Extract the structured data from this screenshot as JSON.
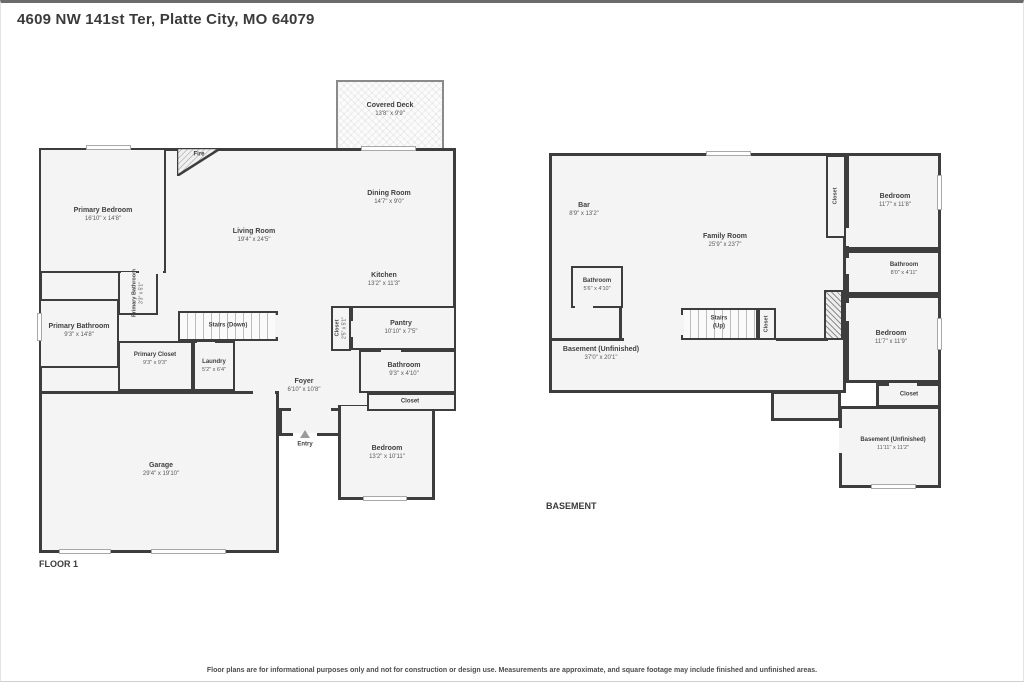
{
  "title": "4609 NW 141st Ter, Platte City, MO 64079",
  "disclaimer": "Floor plans are for informational purposes only and not for construction or design use. Measurements are approximate, and square footage may include finished and unfinished areas.",
  "colors": {
    "wall": "#3d3d3d",
    "room_fill": "#f4f4f4",
    "label_text": "#3f3f3f"
  },
  "floor1": {
    "label": "FLOOR 1",
    "rooms": {
      "covered_deck": {
        "name": "Covered Deck",
        "dims": "13'8\" x 9'9\""
      },
      "fire": {
        "name": "Fire"
      },
      "primary_bedroom": {
        "name": "Primary Bedroom",
        "dims": "16'10\" x 14'8\""
      },
      "living_room": {
        "name": "Living Room",
        "dims": "19'4\" x 24'5\""
      },
      "dining_room": {
        "name": "Dining Room",
        "dims": "14'7\" x 9'0\""
      },
      "kitchen": {
        "name": "Kitchen",
        "dims": "13'2\" x 11'3\""
      },
      "primary_bath_wc": {
        "name": "Primary Bathroom",
        "dims": "3'3\" x 5'1\""
      },
      "primary_bathroom": {
        "name": "Primary Bathroom",
        "dims": "9'3\" x 14'8\""
      },
      "stairs_down": {
        "name": "Stairs (Down)"
      },
      "primary_closet": {
        "name": "Primary Closet",
        "dims": "9'3\" x 9'3\""
      },
      "laundry": {
        "name": "Laundry",
        "dims": "5'2\" x 6'4\""
      },
      "foyer": {
        "name": "Foyer",
        "dims": "6'10\" x 10'8\""
      },
      "closet_foyer": {
        "name": "Closet",
        "dims": "2'5\" x 5'1\""
      },
      "pantry": {
        "name": "Pantry",
        "dims": "10'10\" x 7'5\""
      },
      "bathroom": {
        "name": "Bathroom",
        "dims": "9'3\" x 4'10\""
      },
      "closet_hall": {
        "name": "Closet"
      },
      "entry": {
        "name": "Entry"
      },
      "bedroom": {
        "name": "Bedroom",
        "dims": "13'2\" x 10'11\""
      },
      "garage": {
        "name": "Garage",
        "dims": "29'4\" x 19'10\""
      }
    }
  },
  "basement": {
    "label": "BASEMENT",
    "rooms": {
      "bar": {
        "name": "Bar",
        "dims": "8'9\" x 13'2\""
      },
      "family_room": {
        "name": "Family Room",
        "dims": "25'9\" x 23'7\""
      },
      "bathroom_left": {
        "name": "Bathroom",
        "dims": "5'6\" x 4'10\""
      },
      "stairs_up": {
        "name": "Stairs",
        "sub": "(Up)"
      },
      "closet_stairs": {
        "name": "Closet"
      },
      "unfinished_main": {
        "name": "Basement (Unfinished)",
        "dims": "37'0\" x 20'1\""
      },
      "closet_top": {
        "name": "Closet"
      },
      "bedroom_top": {
        "name": "Bedroom",
        "dims": "11'7\" x 11'8\""
      },
      "bathroom_right": {
        "name": "Bathroom",
        "dims": "8'0\" x 4'11\""
      },
      "bedroom_mid": {
        "name": "Bedroom",
        "dims": "11'7\" x 11'9\""
      },
      "closet_mid": {
        "name": "Closet"
      },
      "unfinished_small": {
        "name": "Basement (Unfinished)",
        "dims": "11'11\" x 11'2\""
      }
    }
  }
}
